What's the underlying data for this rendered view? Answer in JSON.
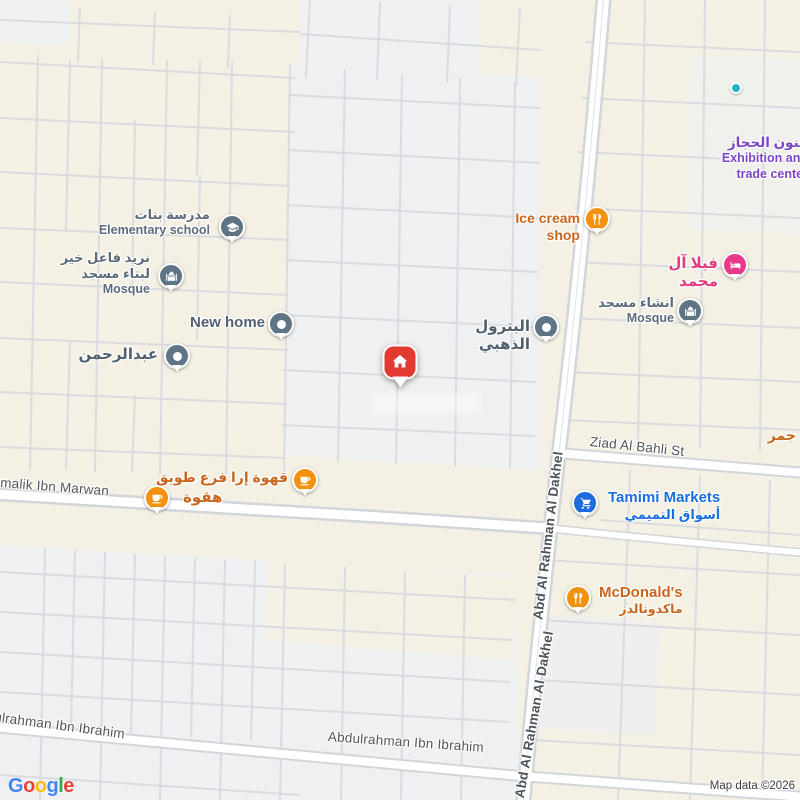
{
  "pois": {
    "elementary_school": {
      "title_ar": "مدرسة بنات",
      "title_en": "Elementary school"
    },
    "mosque_charity": {
      "line1": "نريد فاعل خير",
      "line2": "لبناء مسجد",
      "line3": "Mosque"
    },
    "new_home": {
      "title": "New home"
    },
    "abdulrahman": {
      "title": "عبدالرحمن"
    },
    "golden_petrol": {
      "title": "البترول الذهبي"
    },
    "ice_cream_shop": {
      "title": "Ice cream shop"
    },
    "exhibition_center": {
      "title_ar": "فنون الحجاز",
      "line2": "Exhibition and",
      "line3": "trade center"
    },
    "villa_al_mohammed": {
      "title": "فيلا آل محمد"
    },
    "mosque_inshaa": {
      "title_ar": "انشاء مسجد",
      "title_en": "Mosque"
    },
    "tamimi_markets": {
      "title_en": "Tamimi Markets",
      "title_ar": "أسواق التميمي"
    },
    "mcdonalds": {
      "title_en": "McDonald's",
      "title_ar": "ماكدونالدز"
    },
    "qahwa_era": {
      "title": "قهوة إرا فرع طويق"
    },
    "haqwa": {
      "title": "هقوة"
    },
    "saa_jamar": {
      "title": "سعة جمر"
    }
  },
  "streets": {
    "ziad_al_bahli": "Ziad Al Bahli St",
    "almalik_ibn_marwan": "Almalik Ibn Marwan",
    "abdulrahman_ibn_ibrahim": "Abdulrahman Ibn Ibrahim",
    "abd_al_rahman_al_dakhel": "Abd Al Rahman Al Dakhel"
  },
  "attribution": {
    "logo_letters": [
      "G",
      "o",
      "o",
      "g",
      "l",
      "e"
    ],
    "map_data": "Map data ©2026"
  },
  "colors": {
    "land_beige": "#f4f0e3",
    "block_gray": "#eef0f2",
    "minor_road": "#d8dbe0",
    "major_road_casing": "#d2d6db",
    "major_road_fill": "#ffffff",
    "poi_gray_text": "#5c6b7a",
    "poi_orange_text": "#c9661d",
    "poi_blue_text": "#1a6ede",
    "poi_pink_text": "#df3d7d",
    "poi_purple_text": "#7d44c8",
    "street_text": "#51565c",
    "pin_gray": "#5f7585",
    "pin_orange": "#f2920f",
    "pin_blue": "#1f6ce0",
    "pin_pink": "#e8398b",
    "pin_teal": "#25b3c7",
    "marker_red": "#e23a30"
  }
}
